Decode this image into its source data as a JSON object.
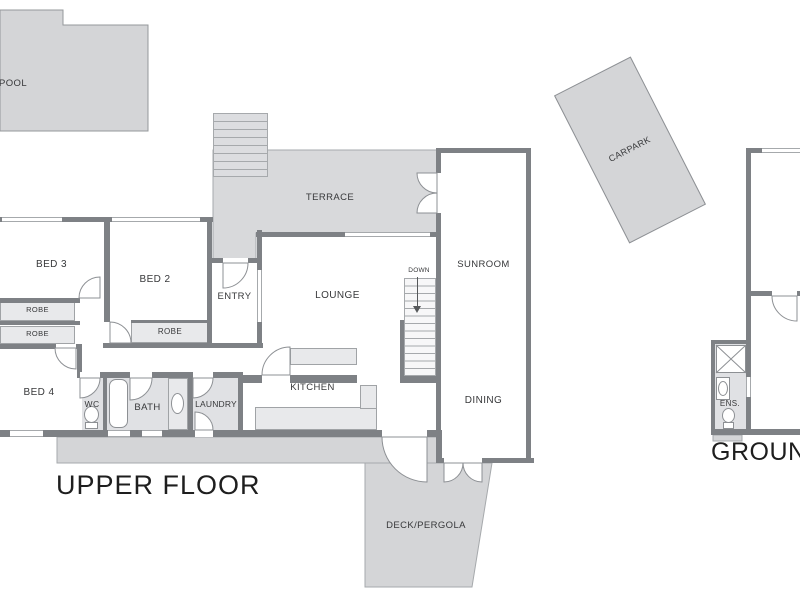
{
  "titles": {
    "upper_floor": "UPPER FLOOR",
    "ground_floor": "GROUND FLOOR"
  },
  "outdoor_areas": {
    "pool": "POOL",
    "terrace": "TERRACE",
    "carpark": "CARPARK",
    "deck_pergola": "DECK/PERGOLA"
  },
  "rooms": {
    "bed3": "BED 3",
    "bed2": "BED 2",
    "bed4": "BED 4",
    "entry": "ENTRY",
    "lounge": "LOUNGE",
    "sunroom": "SUNROOM",
    "dining": "DINING",
    "kitchen": "KITCHEN",
    "wc": "WC",
    "bath": "BATH",
    "laundry": "LAUNDRY",
    "ens": "ENS.",
    "robe1": "ROBE",
    "robe2": "ROBE",
    "robe3": "ROBE"
  },
  "annotations": {
    "down": "DOWN"
  },
  "colors": {
    "wall": "#7e8185",
    "outdoor_fill": "#d4d5d7",
    "terrace_fill": "#d8d9db",
    "wet_floor_fill": "#e0e1e4",
    "joinery_fill": "#e8e9eb",
    "thin_line": "#a6a9ac",
    "text": "#37383a"
  }
}
